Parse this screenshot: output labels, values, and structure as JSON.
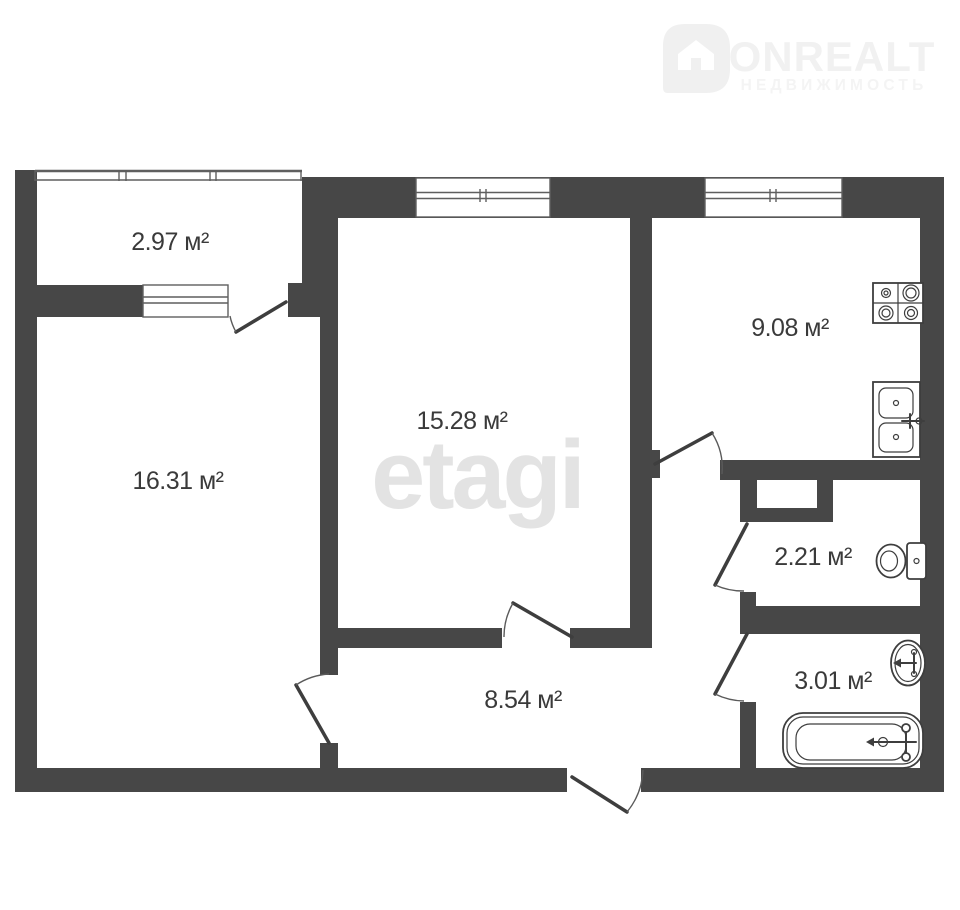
{
  "title": "Apartment floor plan",
  "watermark": {
    "brand": "ONREALT",
    "brand_sub": "НЕДВИЖИМОСТЬ",
    "center_logo": "etagi"
  },
  "rooms": [
    {
      "id": "balcony",
      "area_label": "2.97 м²"
    },
    {
      "id": "living-room",
      "area_label": "16.31 м²"
    },
    {
      "id": "bedroom",
      "area_label": "15.28 м²"
    },
    {
      "id": "kitchen",
      "area_label": "9.08 м²"
    },
    {
      "id": "wc",
      "area_label": "2.21 м²"
    },
    {
      "id": "bathroom",
      "area_label": "3.01 м²"
    },
    {
      "id": "hallway",
      "area_label": "8.54 м²"
    }
  ],
  "fixtures": [
    "stove",
    "kitchen-sink",
    "toilet",
    "bath-sink",
    "bathtub"
  ],
  "colors": {
    "wall": "#474747",
    "line": "#3e3e3e",
    "label_text": "#3a3a3a",
    "watermark_center": "#e3e3e3",
    "watermark_logo": "#f1f1f1",
    "background": "#ffffff"
  }
}
